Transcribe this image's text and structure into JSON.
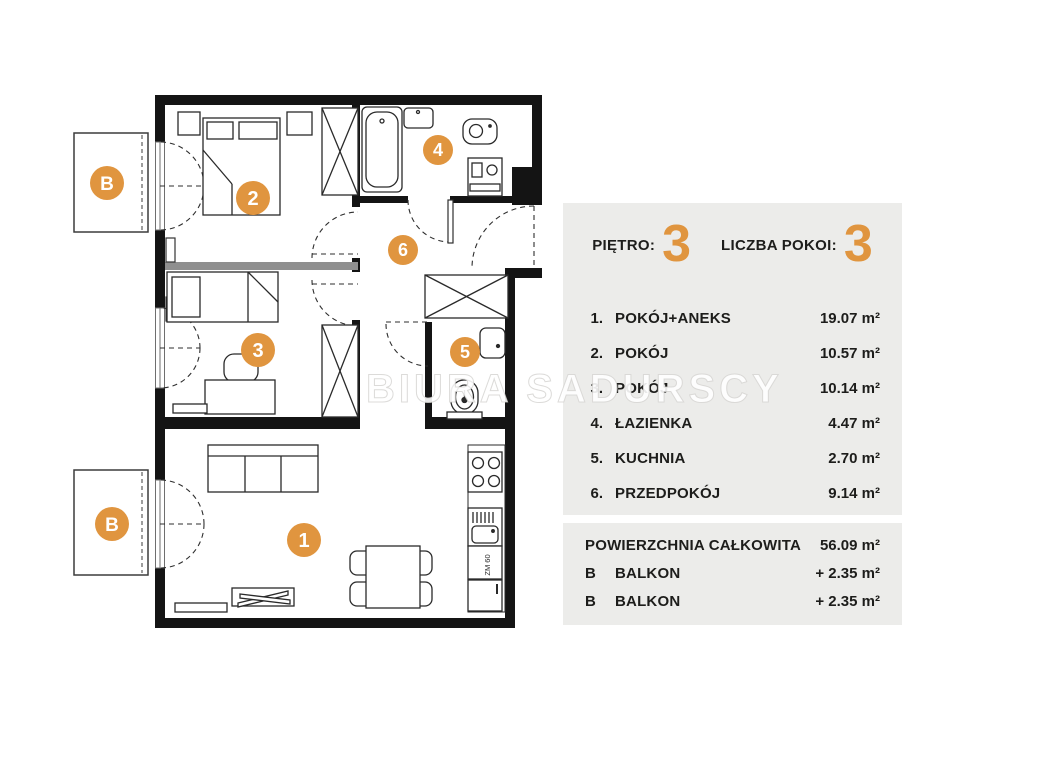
{
  "watermark": "BIURA SADURSCY",
  "colors": {
    "accent": "#e0953f",
    "panel_bg": "#ececea",
    "wall": "#141414",
    "text": "#1d1d1b"
  },
  "panel": {
    "floor": {
      "label": "PIĘTRO:",
      "value": "3"
    },
    "room_count": {
      "label": "LICZBA POKOI:",
      "value": "3"
    },
    "rooms": [
      {
        "no": "1.",
        "name": "POKÓJ+ANEKS",
        "area": "19.07 m²"
      },
      {
        "no": "2.",
        "name": "POKÓJ",
        "area": "10.57 m²"
      },
      {
        "no": "3.",
        "name": "POKÓJ",
        "area": "10.14 m²"
      },
      {
        "no": "4.",
        "name": "ŁAZIENKA",
        "area": "4.47 m²"
      },
      {
        "no": "5.",
        "name": "KUCHNIA",
        "area": "2.70 m²"
      },
      {
        "no": "6.",
        "name": "PRZEDPOKÓJ",
        "area": "9.14 m²"
      }
    ],
    "total": {
      "name": "POWIERZCHNIA CAŁKOWITA",
      "area": "56.09 m²"
    },
    "extras": [
      {
        "no": "B",
        "name": "BALKON",
        "area": "+ 2.35 m²"
      },
      {
        "no": "B",
        "name": "BALKON",
        "area": "+ 2.35 m²"
      }
    ]
  },
  "plan": {
    "markers": {
      "room1": "1",
      "room2": "2",
      "room3": "3",
      "room4": "4",
      "room5": "5",
      "room6": "6",
      "balcony": "B"
    },
    "labels": {
      "dishwasher": "ZM 60"
    }
  }
}
